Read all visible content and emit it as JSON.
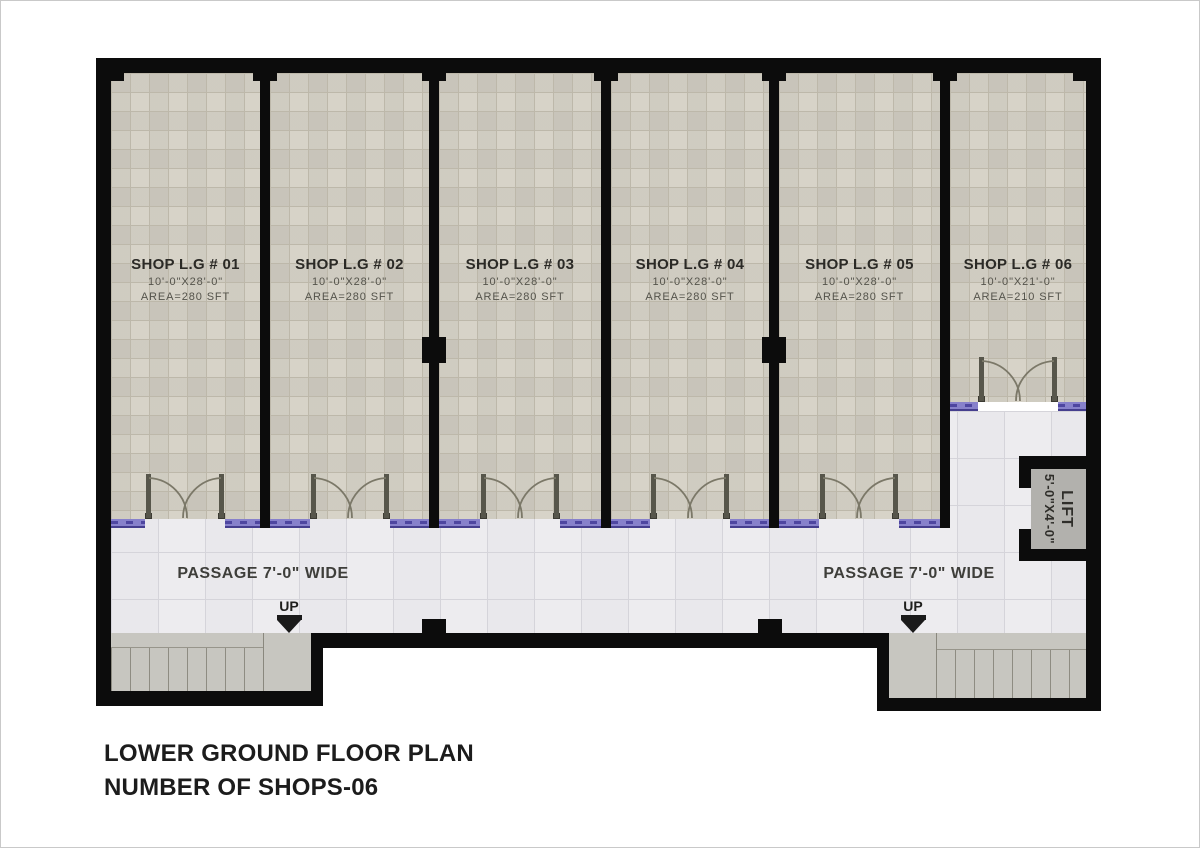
{
  "plan": {
    "title_line1": "LOWER GROUND FLOOR PLAN",
    "title_line2": "NUMBER OF SHOPS-06"
  },
  "shops": [
    {
      "name": "SHOP L.G # 01",
      "dim": "10'-0\"X28'-0\"",
      "area": "AREA=280  SFT"
    },
    {
      "name": "SHOP L.G # 02",
      "dim": "10'-0\"X28'-0\"",
      "area": "AREA=280  SFT"
    },
    {
      "name": "SHOP L.G # 03",
      "dim": "10'-0\"X28'-0\"",
      "area": "AREA=280  SFT"
    },
    {
      "name": "SHOP L.G # 04",
      "dim": "10'-0\"X28'-0\"",
      "area": "AREA=280  SFT"
    },
    {
      "name": "SHOP L.G # 05",
      "dim": "10'-0\"X28'-0\"",
      "area": "AREA=280  SFT"
    },
    {
      "name": "SHOP L.G # 06",
      "dim": "10'-0\"X21'-0\"",
      "area": "AREA=210  SFT"
    }
  ],
  "passages": {
    "left_label": "PASSAGE 7'-0\" WIDE",
    "right_label": "PASSAGE 7'-0\" WIDE"
  },
  "stairs": {
    "left_up_label": "UP",
    "right_up_label": "UP"
  },
  "lift": {
    "name": "LIFT",
    "dim": "5'-0\"X4'-0\""
  },
  "colors": {
    "wall": "#0c0c0c",
    "shop_floor": "#d6d2c7",
    "passage_floor": "#edecef",
    "storefront_glazing": "#8781cb",
    "storefront_frame": "#453e8e",
    "stairs": "#c7c6c0",
    "lift_floor": "#b2b1ad"
  }
}
